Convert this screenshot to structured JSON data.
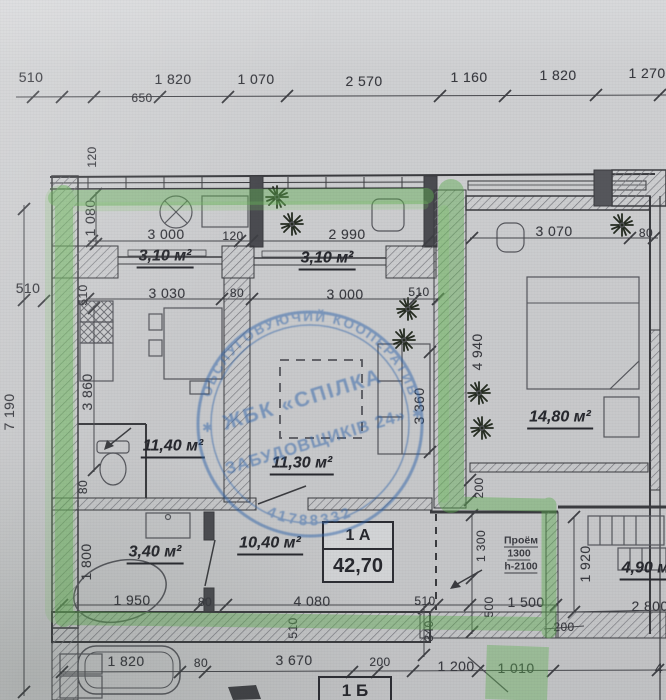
{
  "dims": {
    "top": [
      "510",
      "650",
      "1 820",
      "1 070",
      "2 570",
      "1 160",
      "1 820",
      "1 270"
    ],
    "left": [
      "120",
      "1 080",
      "510",
      "510",
      "3 860",
      "7 190",
      "80",
      "1 800"
    ],
    "upper": [
      "3 000",
      "120",
      "2 990",
      "3 070",
      "80"
    ],
    "inner": [
      "3 030",
      "80",
      "3 000",
      "510",
      "3 360",
      "4 940"
    ],
    "lower": [
      "1 950",
      "80",
      "4 080",
      "510",
      "1 500",
      "1 300",
      "500",
      "340",
      "200",
      "1 920",
      "200",
      "2 800"
    ],
    "bottom": [
      "1 820",
      "80",
      "3 670",
      "200",
      "1 200",
      "1 010",
      "4",
      "510"
    ]
  },
  "areas": {
    "balcony1": "3,10 м²",
    "balcony2": "3,10 м²",
    "kitchen": "11,40 м²",
    "living": "11,30 м²",
    "bedroom": "14,80 м²",
    "bathroom": "3,40 м²",
    "hallway": "10,40 м²",
    "neighbor_room": "4,90 м²"
  },
  "unit_a": {
    "label": "1 А",
    "total_area": "42,70"
  },
  "unit_b": {
    "label": "1 Б"
  },
  "opening": {
    "name": "Проём",
    "width": "1300",
    "height": "h-2100"
  },
  "stamp": {
    "arc_top": "ОБСЛУГОВУЮЧИЙ КООПЕРАТИВ",
    "name_line1": "ЖБК «СПІЛКА",
    "name_line2": "ЗАБУДОВЩИКІВ 24»",
    "code": "41788332",
    "star": "✱"
  },
  "colors": {
    "highlight_green": "#5fae52",
    "stamp_blue": "#2f63aa",
    "pencil": "#3a3b41"
  }
}
